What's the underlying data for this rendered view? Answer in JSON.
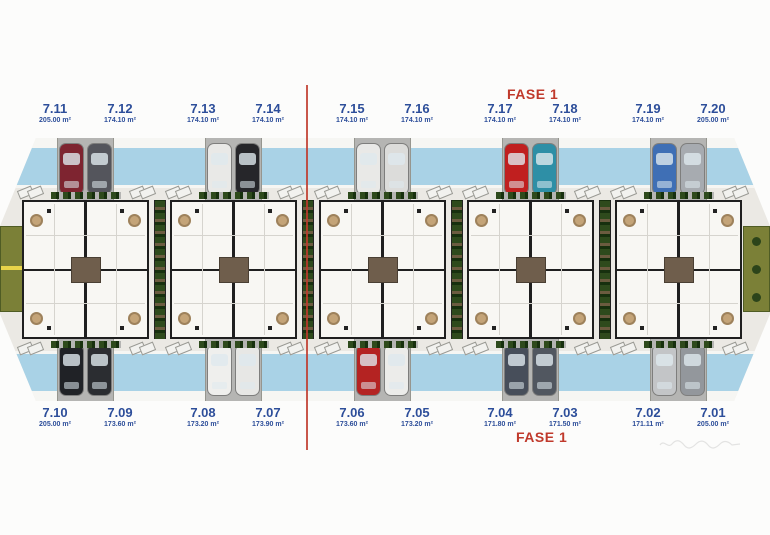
{
  "phase": {
    "label": "FASE 1"
  },
  "units": {
    "top": [
      {
        "number": "7.11",
        "area": "205.00 m²"
      },
      {
        "number": "7.12",
        "area": "174.10 m²"
      },
      {
        "number": "7.13",
        "area": "174.10 m²"
      },
      {
        "number": "7.14",
        "area": "174.10 m²"
      },
      {
        "number": "7.15",
        "area": "174.10 m²"
      },
      {
        "number": "7.16",
        "area": "174.10 m²"
      },
      {
        "number": "7.17",
        "area": "174.10 m²"
      },
      {
        "number": "7.18",
        "area": "174.10 m²"
      },
      {
        "number": "7.19",
        "area": "174.10 m²"
      },
      {
        "number": "7.20",
        "area": "205.00 m²"
      }
    ],
    "bottom": [
      {
        "number": "7.10",
        "area": "205.00 m²"
      },
      {
        "number": "7.09",
        "area": "173.60 m²"
      },
      {
        "number": "7.08",
        "area": "173.20 m²"
      },
      {
        "number": "7.07",
        "area": "173.90 m²"
      },
      {
        "number": "7.06",
        "area": "173.60 m²"
      },
      {
        "number": "7.05",
        "area": "173.20 m²"
      },
      {
        "number": "7.04",
        "area": "171.80 m²"
      },
      {
        "number": "7.03",
        "area": "171.50 m²"
      },
      {
        "number": "7.02",
        "area": "171.11 m²"
      },
      {
        "number": "7.01",
        "area": "205.00 m²"
      }
    ]
  },
  "blocks": [
    {
      "top_cars": [
        "#7e2430",
        "#54555c"
      ],
      "bottom_cars": [
        "#202226",
        "#2b2d31"
      ]
    },
    {
      "top_cars": [
        "#e9e9e7",
        "#26262a"
      ],
      "bottom_cars": [
        "#efefed",
        "#e7e7e5"
      ]
    },
    {
      "top_cars": [
        "#e9e9e7",
        "#dcdcda"
      ],
      "bottom_cars": [
        "#b42322",
        "#ececea"
      ]
    },
    {
      "top_cars": [
        "#c01f1f",
        "#2e8fa6"
      ],
      "bottom_cars": [
        "#474e5a",
        "#515760"
      ]
    },
    {
      "top_cars": [
        "#3f6fb5",
        "#a7abb0"
      ],
      "bottom_cars": [
        "#c3c5c7",
        "#93979c"
      ]
    }
  ],
  "colors": {
    "unit_label": "#2d4e9a",
    "phase_label": "#c0392b",
    "divider_line": "#c0392b",
    "pool": "#a9d2e6",
    "driveway": "#b5b5b3",
    "ground": "#ebe9e4",
    "building": "#f8f7f3",
    "wall": "#1f1f1f",
    "hedge": "#2e4a1c",
    "olive": "#7b8037",
    "terrace": "#c4a478",
    "stair_brown": "#6f5e4c"
  }
}
